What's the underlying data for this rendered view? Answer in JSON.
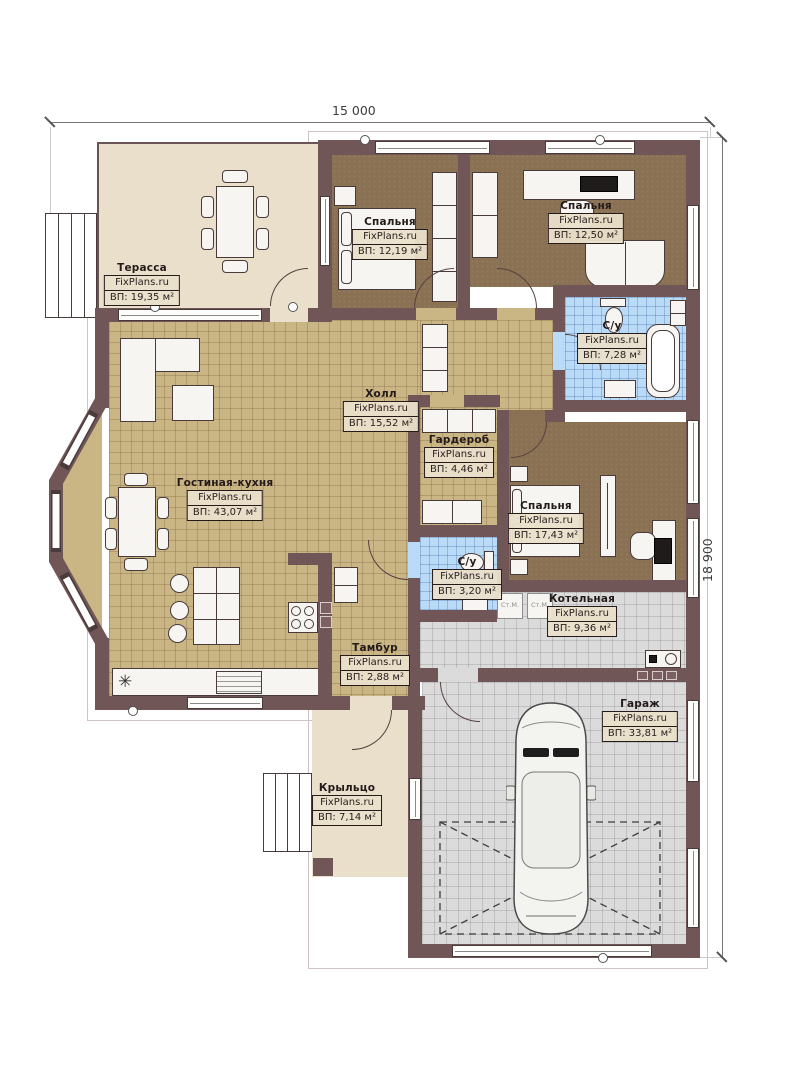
{
  "watermark": "FixPlans.ru",
  "dimensions": {
    "width": "15 000",
    "height": "18 900"
  },
  "rooms": [
    {
      "name": "Терасса",
      "area": "ВП: 19,35 м²"
    },
    {
      "name": "Спальня",
      "area": "ВП: 12,19 м²"
    },
    {
      "name": "Спальня",
      "area": "ВП: 12,50 м²"
    },
    {
      "name": "С/у",
      "area": "ВП: 7,28 м²"
    },
    {
      "name": "Холл",
      "area": "ВП: 15,52 м²"
    },
    {
      "name": "Гардероб",
      "area": "ВП: 4,46 м²"
    },
    {
      "name": "Гостиная-кухня",
      "area": "ВП: 43,07 м²"
    },
    {
      "name": "Спальня",
      "area": "ВП: 17,43 м²"
    },
    {
      "name": "С/у",
      "area": "ВП: 3,20 м²"
    },
    {
      "name": "Котельная",
      "area": "ВП: 9,36 м²"
    },
    {
      "name": "Тамбур",
      "area": "ВП: 2,88 м²"
    },
    {
      "name": "Гараж",
      "area": "ВП: 33,81 м²"
    },
    {
      "name": "Крыльцо",
      "area": "ВП: 7,14 м²"
    }
  ],
  "appliances": {
    "washers": [
      "Ст.М.",
      "Ст.М."
    ]
  },
  "symbols": {
    "sink": "✳"
  },
  "palette": {
    "wall": "#715658",
    "floor_tile": "#cab585",
    "floor_wood": "#8a7153",
    "floor_bath": "#badbf7",
    "floor_garage": "#dbdbdb",
    "floor_terrace": "#e9dfcb"
  }
}
